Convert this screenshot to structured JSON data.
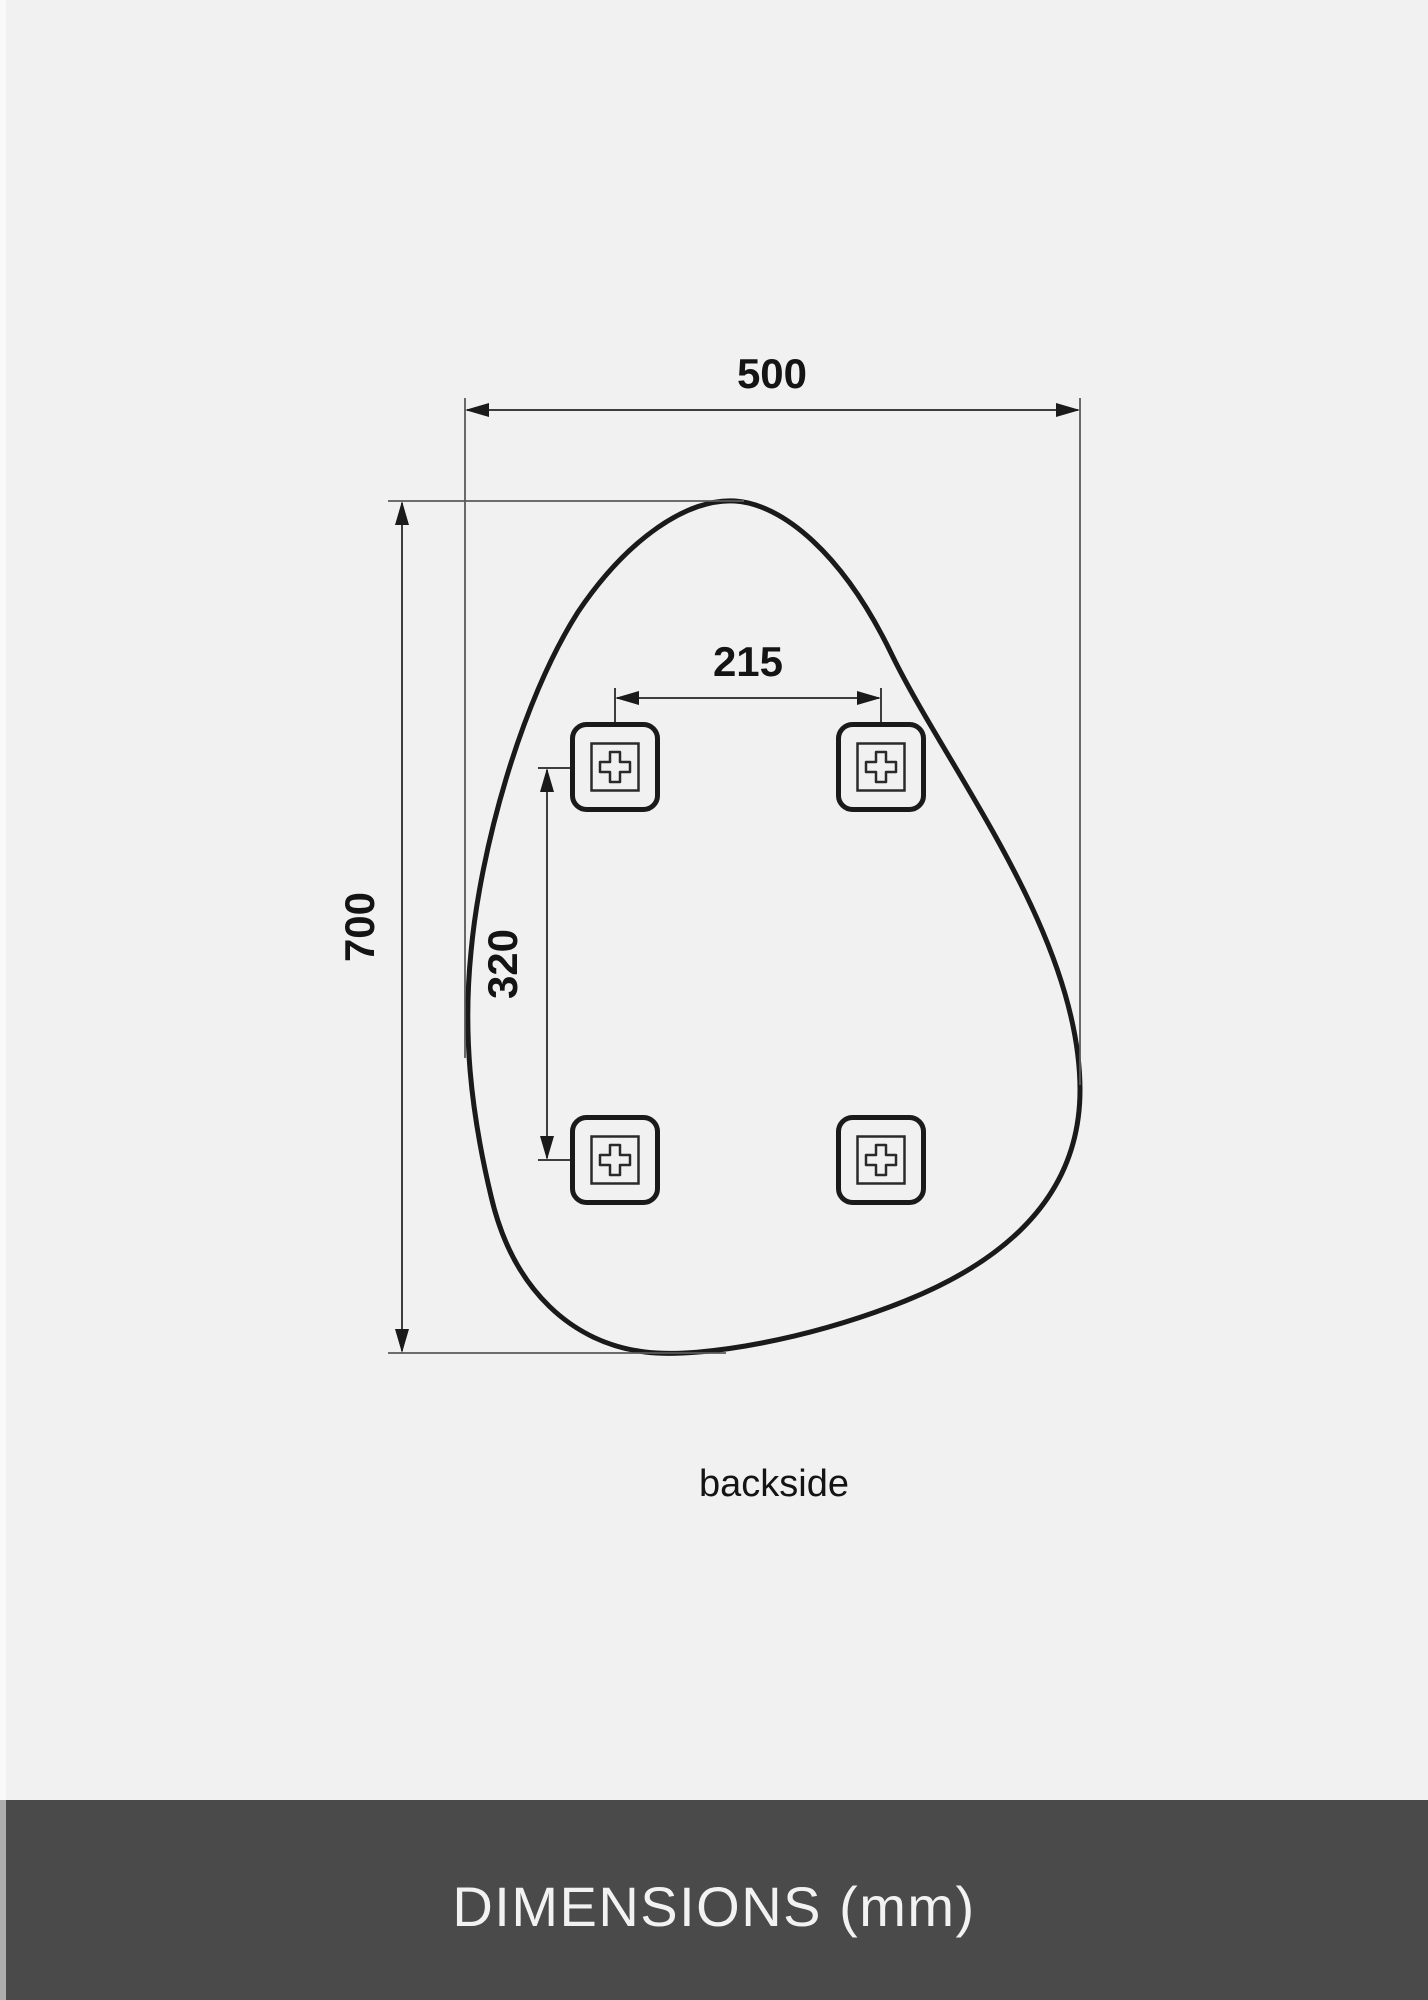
{
  "page": {
    "background_color": "#f1f1f2",
    "line_color": "#1a1a1a",
    "dimension_line_color": "#3d3d3d"
  },
  "diagram": {
    "caption": "backside",
    "unit": "mm",
    "overall_width_label": "500",
    "overall_height_label": "700",
    "bracket_spacing_horizontal_label": "215",
    "bracket_spacing_vertical_label": "320",
    "bracket_count": 4
  },
  "footer": {
    "label": "DIMENSIONS (mm)",
    "background_color": "#4a4a4a",
    "text_color": "#f2f2f2"
  }
}
